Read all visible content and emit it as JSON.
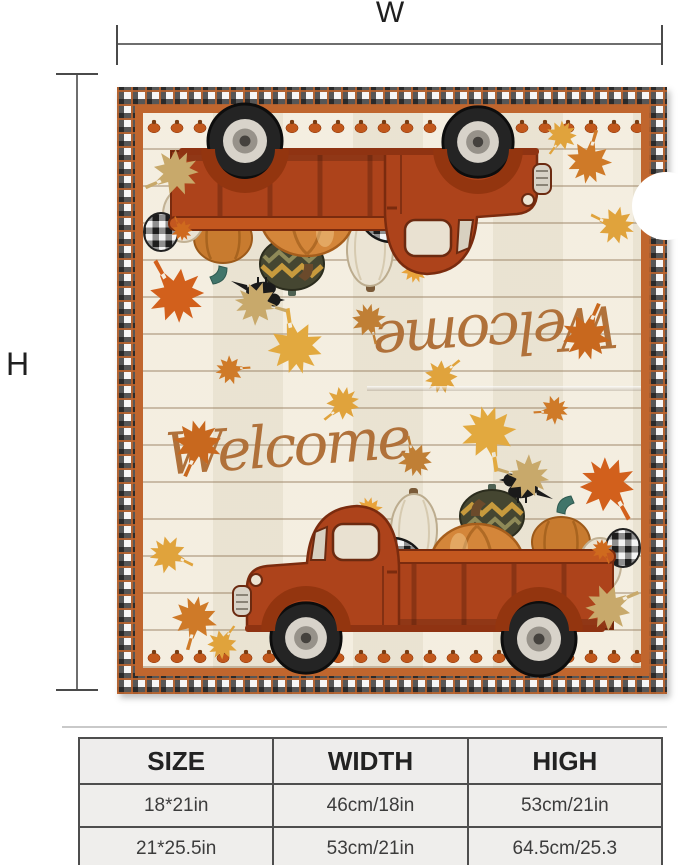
{
  "measurements": {
    "width_label": "W",
    "height_label": "H"
  },
  "flag": {
    "welcome_text": "Welcome",
    "colors": {
      "frame_orange": "#c0662e",
      "truck_rust": "#ad431b",
      "script_brown": "#b0713a",
      "pumpkin_orange": "#d4863a",
      "wood_cream": "#f1ead9"
    }
  },
  "size_table": {
    "headers": [
      "SIZE",
      "WIDTH",
      "HIGH"
    ],
    "rows": [
      [
        "18*21in",
        "46cm/18in",
        "53cm/21in"
      ],
      [
        "21*25.5in",
        "53cm/21in",
        "64.5cm/25.3"
      ]
    ]
  }
}
